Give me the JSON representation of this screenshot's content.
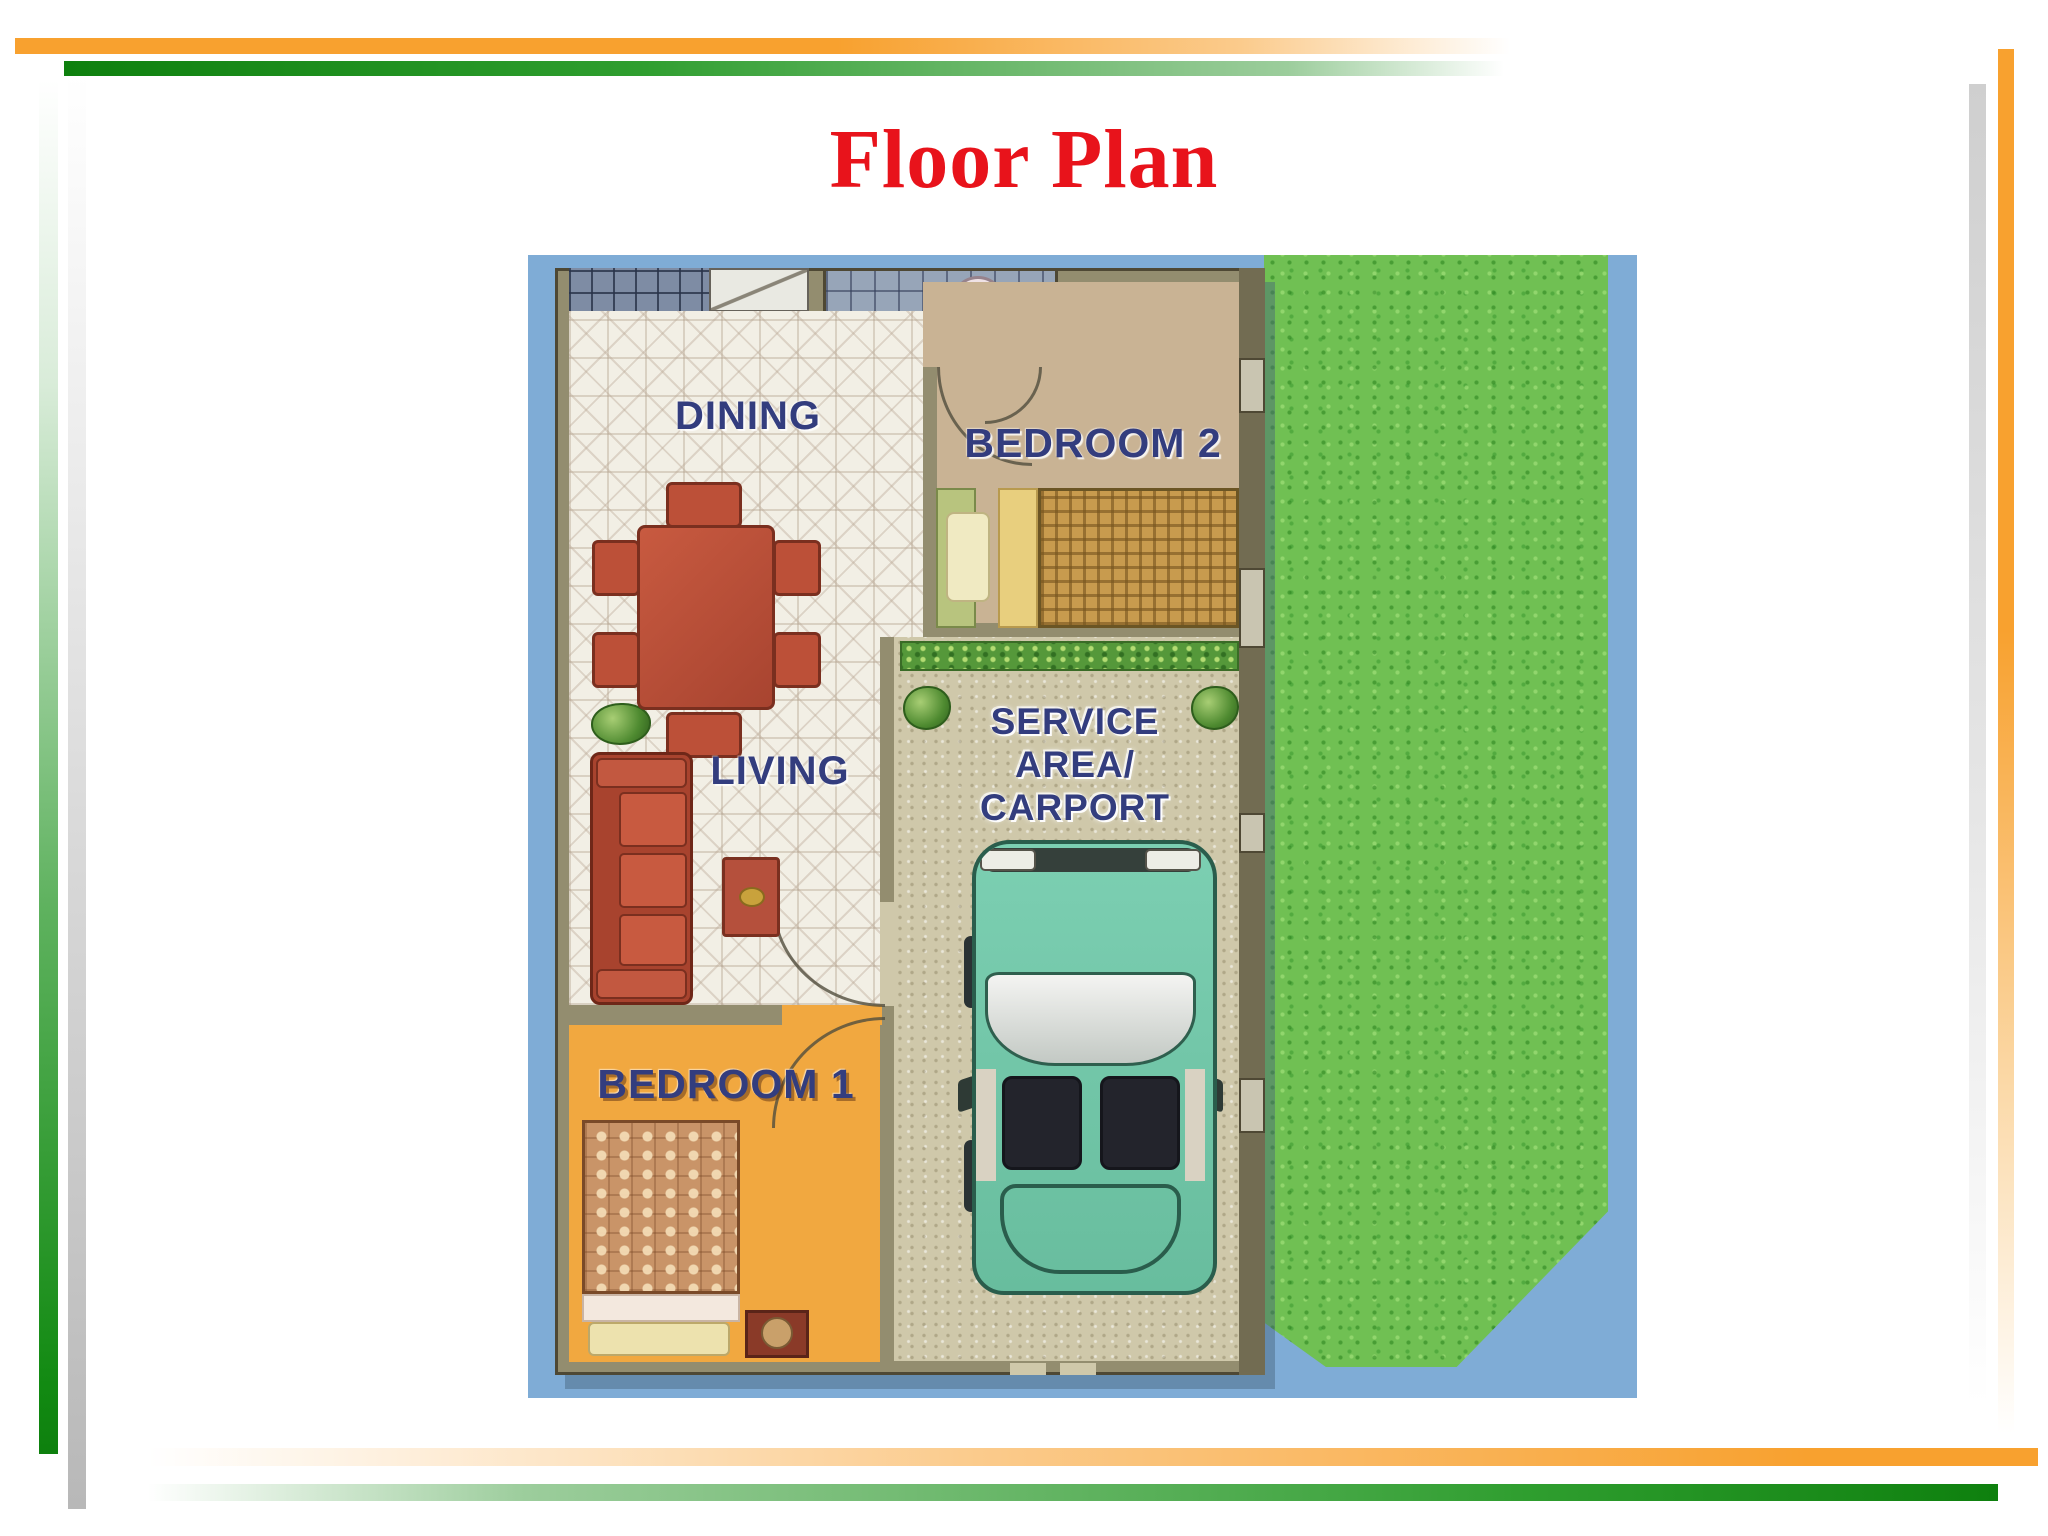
{
  "slide": {
    "title": "Floor Plan"
  },
  "floor_plan": {
    "labels": {
      "dining": "DINING",
      "bedroom2": "BEDROOM 2",
      "living": "LIVING",
      "bedroom1": "BEDROOM 1",
      "service_line1": "SERVICE",
      "service_line2": "AREA/",
      "service_line3": "CARPORT"
    },
    "colors": {
      "water_blue": "#7FACD6",
      "grass_green": "#70C053",
      "label_navy": "#333D7E",
      "tile_cream": "#F2EFE5",
      "bedroom1_floor_orange": "#F1A840",
      "bedroom2_floor_tan": "#C9B394",
      "furniture_terracotta": "#BC5038",
      "car_teal": "#76C9AB"
    }
  },
  "theme": {
    "title_red": "#E8131B",
    "bar_orange": "#F8A12F",
    "bar_green": "#0E800E",
    "bar_gray": "#BDBDBD"
  }
}
